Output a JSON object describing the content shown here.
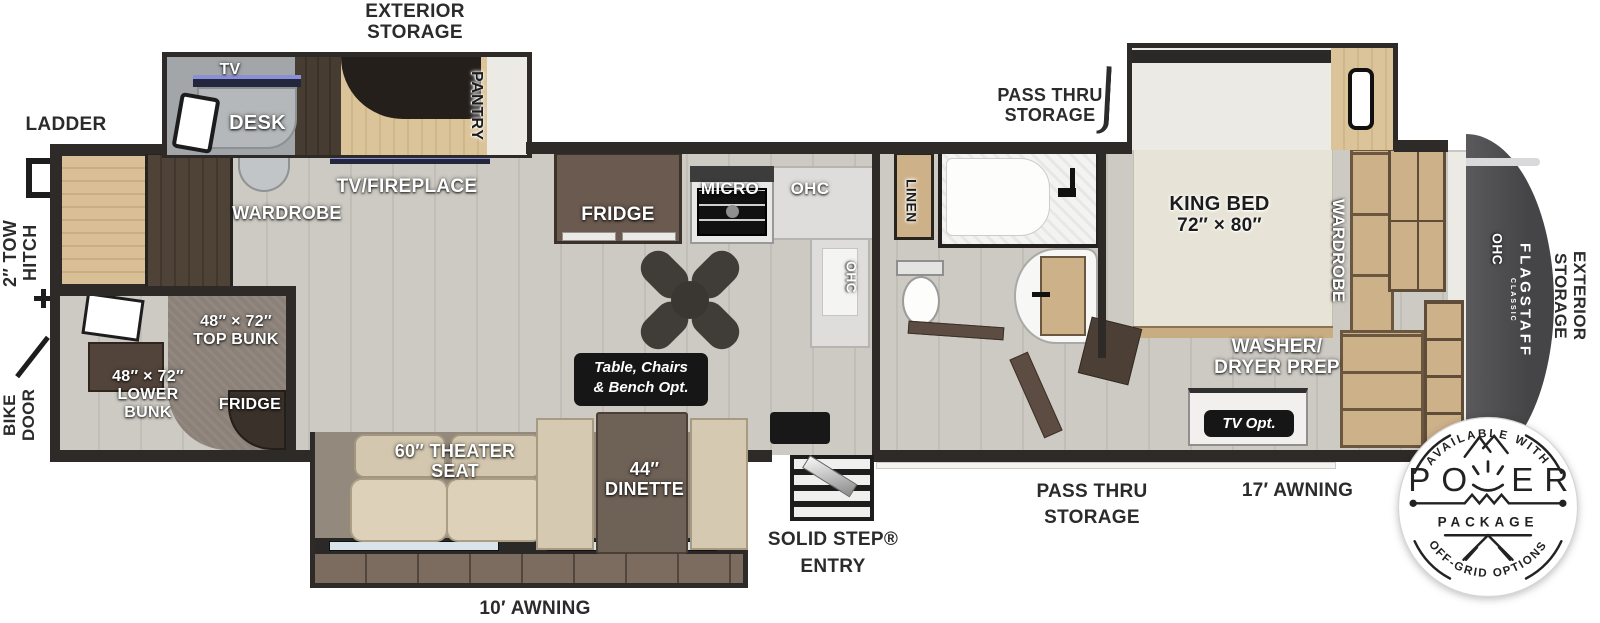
{
  "colors": {
    "wall": "#2d2a27",
    "floor": "#cbc8c1",
    "wood": "#d3b98e",
    "rear_cap": "#4e4e50",
    "tv_accent": "#8a90d8"
  },
  "exterior": {
    "storage_top_l1": "EXTERIOR",
    "storage_top_l2": "STORAGE",
    "ladder": "LADDER",
    "tow_hitch_l1": "2″ TOW",
    "tow_hitch_l2": "HITCH",
    "bike_door_l1": "BIKE",
    "bike_door_l2": "DOOR",
    "pass_thru_top_l1": "PASS THRU",
    "pass_thru_top_l2": "STORAGE",
    "pass_thru_bottom_l1": "PASS THRU",
    "pass_thru_bottom_l2": "STORAGE",
    "solid_step_l1": "SOLID STEP®",
    "solid_step_l2": "ENTRY",
    "awning_10": "10′ AWNING",
    "awning_17": "17′ AWNING",
    "storage_rear_l1": "EXTERIOR",
    "storage_rear_l2": "STORAGE"
  },
  "bunk_room": {
    "wardrobe": "WARDROBE",
    "top_bunk_l1": "48″ × 72″",
    "top_bunk_l2": "TOP BUNK",
    "lower_bunk_l1": "48″ × 72″",
    "lower_bunk_l2": "LOWER",
    "lower_bunk_l3": "BUNK",
    "fridge": "FRIDGE"
  },
  "desk_slide": {
    "tv": "TV",
    "desk": "DESK",
    "pantry": "PANTRY",
    "tv_fireplace": "TV/FIREPLACE"
  },
  "kitchen": {
    "fridge": "FRIDGE",
    "micro": "MICRO",
    "ohc_top": "OHC",
    "ohc_side": "OHC",
    "table_opt_l1": "Table, Chairs",
    "table_opt_l2": "& Bench Opt."
  },
  "bath": {
    "linen": "LINEN"
  },
  "bedroom": {
    "king_bed_l1": "KING BED",
    "king_bed_l2": "72″ × 80″",
    "wardrobe": "WARDROBE",
    "washer_l1": "WASHER/",
    "washer_l2": "DRYER PREP",
    "tv_opt": "TV Opt."
  },
  "living": {
    "theater_l1": "60″ THEATER",
    "theater_l2": "SEAT",
    "dinette_l1": "44″",
    "dinette_l2": "DINETTE"
  },
  "rear": {
    "ohc": "OHC",
    "brand": "FLAGSTAFF",
    "brand_sub": "CLASSIC"
  },
  "badge": {
    "arc_top": "AVAILABLE WITH",
    "power_left": "PO",
    "power_right": "ER",
    "package": "PACKAGE",
    "arc_bottom": "OFF-GRID OPTIONS"
  }
}
